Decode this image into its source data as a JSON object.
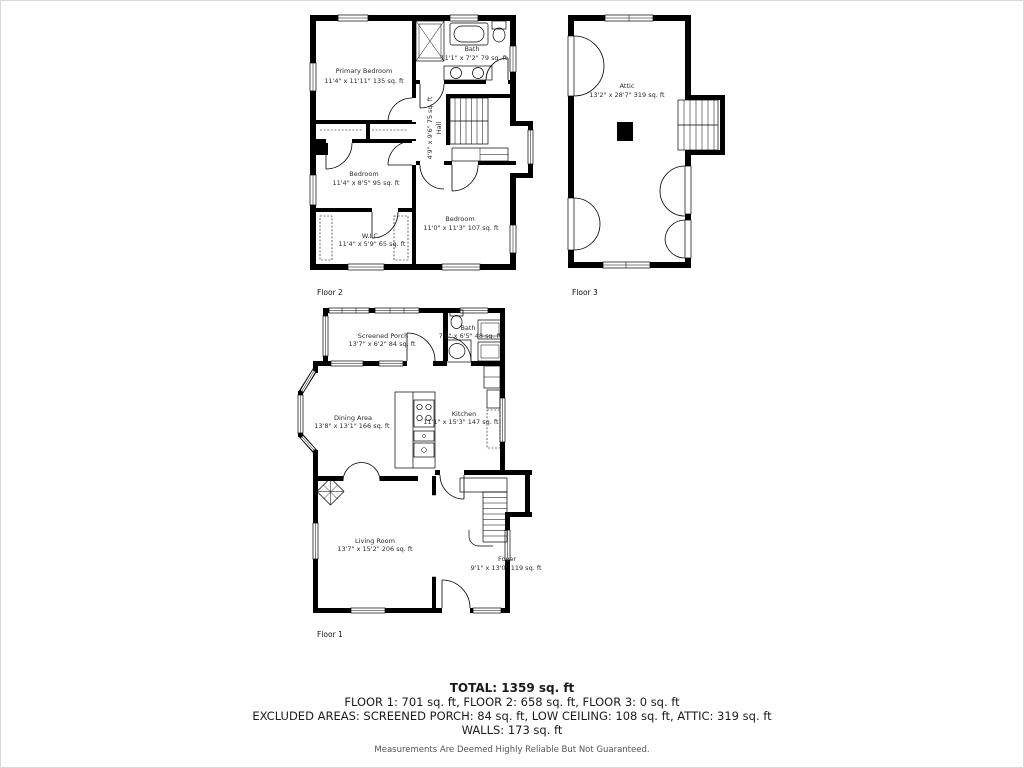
{
  "colors": {
    "wall": "#000000",
    "room_text": "#2b2b2b",
    "disclaimer_text": "#555555"
  },
  "floors": {
    "f1": {
      "label": "Floor 1",
      "rooms": {
        "porch": {
          "name": "Screened Porch",
          "dims": "13'7\" x 6'2\" 84 sq. ft"
        },
        "bath": {
          "name": "Bath",
          "dims": "7'5\" x 6'5\" 48 sq. ft"
        },
        "dining": {
          "name": "Dining Area",
          "dims": "13'8\" x 13'1\" 166 sq. ft"
        },
        "kitchen": {
          "name": "Kitchen",
          "dims": "11'1\" x 15'3\" 147 sq. ft"
        },
        "living": {
          "name": "Living Room",
          "dims": "13'7\" x 15'2\" 206 sq. ft"
        },
        "foyer": {
          "name": "Foyer",
          "dims": "9'1\" x 13'0\" 119 sq. ft"
        }
      }
    },
    "f2": {
      "label": "Floor 2",
      "rooms": {
        "primary": {
          "name": "Primary Bedroom",
          "dims": "11'4\" x 11'11\" 135 sq. ft"
        },
        "bath": {
          "name": "Bath",
          "dims": "11'1\" x 7'2\" 79 sq. ft"
        },
        "hall": {
          "name": "Hall",
          "dims": "4'9\" x 9'6\" 75 sq. ft"
        },
        "bedroom_left": {
          "name": "Bedroom",
          "dims": "11'4\" x 8'5\" 95 sq. ft"
        },
        "wic": {
          "name": "W.I.C.",
          "dims": "11'4\" x 5'9\" 65 sq. ft"
        },
        "bedroom_right": {
          "name": "Bedroom",
          "dims": "11'0\" x 11'3\" 107 sq. ft"
        }
      }
    },
    "f3": {
      "label": "Floor 3",
      "rooms": {
        "attic": {
          "name": "Attic",
          "dims": "13'2\" x 28'7\" 319 sq. ft"
        }
      }
    }
  },
  "summary": {
    "total": "TOTAL: 1359 sq. ft",
    "floors_line": "FLOOR 1: 701 sq. ft, FLOOR 2: 658 sq. ft, FLOOR 3: 0 sq. ft",
    "excluded_line": "EXCLUDED AREAS: SCREENED PORCH: 84 sq. ft, LOW CEILING: 108 sq. ft, ATTIC: 319 sq. ft",
    "walls_line": "WALLS: 173 sq. ft",
    "disclaimer": "Measurements Are Deemed Highly Reliable But Not Guaranteed."
  }
}
